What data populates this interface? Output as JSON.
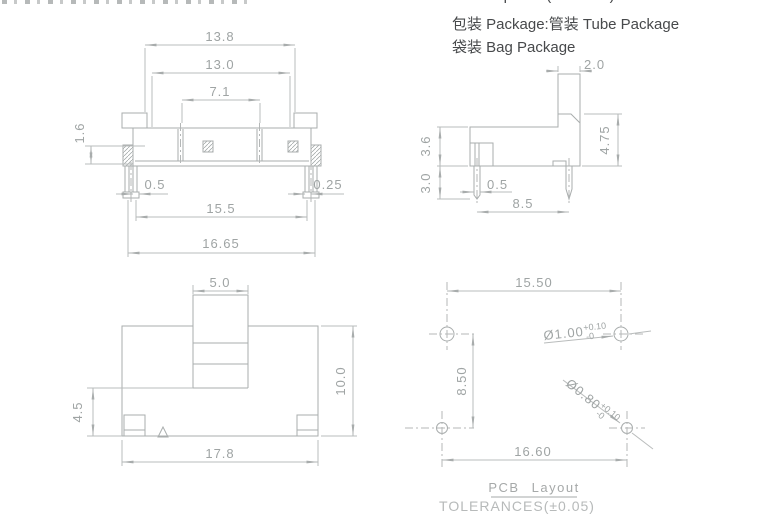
{
  "header": {
    "material": "Thermoplastic(UL94V-0)",
    "package_tube": "包装 Package:管装 Tube Package",
    "package_bag": "袋装 Bag Package"
  },
  "front_view": {
    "top_width": "13.8",
    "cover_width": "13.0",
    "contact_pitch": "7.1",
    "bracket_height": "1.6",
    "left_leg_width": "0.5",
    "right_leg_width": "0.25",
    "leg_span": "15.5",
    "overall_width": "16.65"
  },
  "side_view": {
    "knob_thickness": "2.0",
    "face_height": "4.75",
    "body_height": "3.6",
    "pin_length": "3.0",
    "pin_width": "0.5",
    "pin_pitch": "8.5"
  },
  "top_view": {
    "knob_width": "5.0",
    "body_depth": "10.0",
    "knob_offset": "4.5",
    "body_width": "17.8"
  },
  "pcb_layout": {
    "title": "PCB Layout",
    "tolerance_note": "TOLERANCES(±0.05)",
    "top_hole_pitch": "15.50",
    "row_pitch": "8.50",
    "bottom_hole_pitch": "16.60",
    "top_hole": {
      "diameter": "Ø1.00",
      "tol_upper": "+0.10",
      "tol_lower": "-0"
    },
    "bottom_hole": {
      "diameter": "Ø0.80",
      "tol_upper": "+0.10",
      "tol_lower": "-0"
    }
  }
}
